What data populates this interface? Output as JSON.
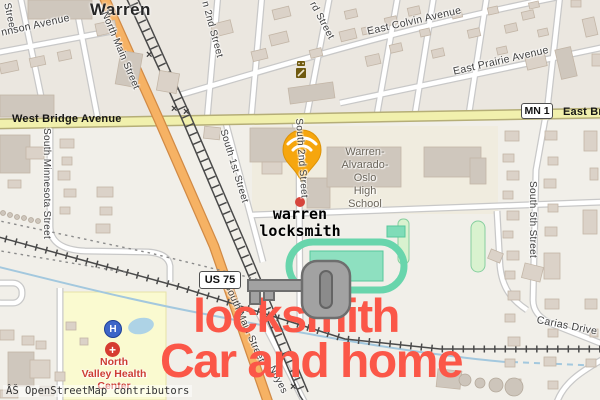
{
  "map": {
    "town": "Warren",
    "attribution": "ÂŠ OpenStreetMap contributors",
    "crossing_mark": "×",
    "badges": {
      "mn1": "MN 1",
      "us75": "US 75"
    },
    "street_labels": {
      "street_fragment": "Street",
      "johnson": "nnson Avenue",
      "north_main": "North Main Street",
      "second_n": "n 2nd Street",
      "third_n": "rd Street",
      "east_colvin": "East Colvin Avenue",
      "east_prairie": "East Prairie Avenue",
      "west_bridge": "West Bridge Avenue",
      "east_bridge": "East Br",
      "s_minnesota": "South Minnesota Street",
      "s_1st": "South 1st Street",
      "s_2nd": "South 2nd Street",
      "s_5th": "South 5th Street",
      "south_main": "South Main Street",
      "noyes": "Noyes",
      "carias": "Carias Drive"
    },
    "pois": {
      "school": {
        "lines": [
          "Warren-",
          "Alvarado-",
          "Oslo",
          "High",
          "School"
        ]
      },
      "hospital": {
        "lines": [
          "North",
          "Valley Health",
          "Center"
        ],
        "helipad": "H",
        "cross": "+"
      }
    }
  },
  "overlay": {
    "pin_label_line1": "warren",
    "pin_label_line2": "locksmith",
    "headline_line1": "locksmith",
    "headline_line2": "Car and home",
    "colors": {
      "headline_red": "#fb5748",
      "pin_yellow": "#f6a60e",
      "key_gray": "#a2a2a2",
      "track_green": "#68d5ac",
      "hospital_label_red": "#cd3d33",
      "road_orange": "#f6b264",
      "road_yellow": "#f1f0ad"
    }
  }
}
